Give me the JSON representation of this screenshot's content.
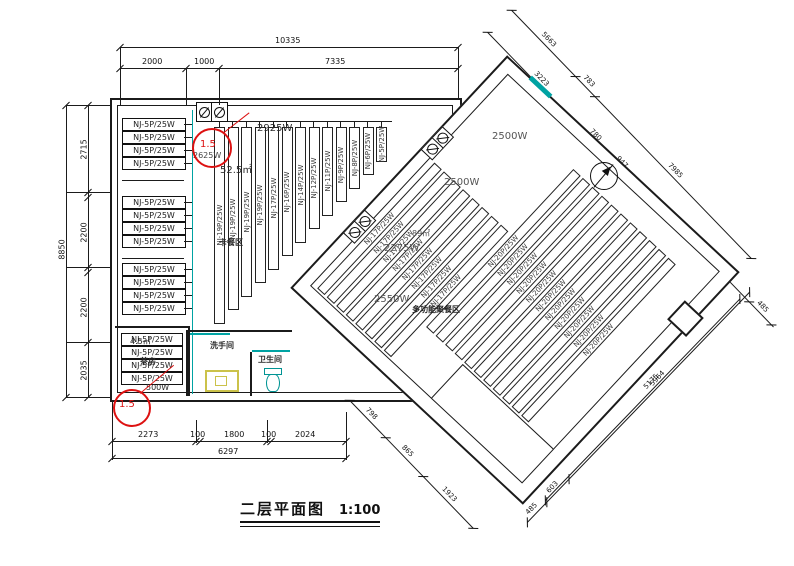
{
  "title": {
    "text": "二层平面图",
    "scale": "1:100"
  },
  "colors": {
    "line": "#1b1b1b",
    "teal": "#00a3a3",
    "red": "#dd1111",
    "yellow": "#cbc24a"
  },
  "left_room": {
    "panel_label": "NJ-5P/25W",
    "panel_groups": [
      4,
      4,
      4
    ],
    "strips": [
      {
        "label": "NJ-19P/25W"
      },
      {
        "label": "NJ-19P/25W"
      },
      {
        "label": "NJ-19P/25W"
      },
      {
        "label": "NJ-19P/25W"
      },
      {
        "label": "NJ-17P/25W"
      },
      {
        "label": "NJ-16P/25W"
      },
      {
        "label": "NJ-14P/25W"
      },
      {
        "label": "NJ-12P/25W"
      },
      {
        "label": "NJ-11P/25W"
      },
      {
        "label": "NJ-9P/25W"
      },
      {
        "label": "NJ-8P/25W"
      },
      {
        "label": "NJ-6P/25W"
      },
      {
        "label": "NJ-5P/25W"
      }
    ],
    "texts": {
      "power_a": "2625W",
      "power_b": "2925W",
      "area": "52.5㎡",
      "zone": "卡餐区"
    },
    "tea_room": {
      "name": "茶房",
      "area": "4.5㎡",
      "power": "500W",
      "panel_label": "NJ-5P/25W",
      "panel_count": 4
    },
    "washroom_label": "洗手间",
    "toilet_label": "卫生间",
    "markup_top": "1.5",
    "markup_bottom": "1.5"
  },
  "rotated_room": {
    "strips_left": {
      "label": "NJ-17P/25W",
      "count": 8
    },
    "strips_right": {
      "label": "NJ-20P/25W",
      "count": 11
    },
    "texts": {
      "power_top": "2500W",
      "power_mid": "2500W",
      "power_low": "2275W",
      "power_bottom": "2550W",
      "area": "89㎡",
      "zone": "多功能聚餐区"
    }
  },
  "dimensions": {
    "top": {
      "overall": "10335",
      "segments": [
        "2000",
        "1000",
        "7335"
      ]
    },
    "left": {
      "overall": "8850",
      "segments": [
        "2715",
        "2200",
        "2200",
        "2035"
      ]
    },
    "bottom": {
      "overall": "6297",
      "segments": [
        "2273",
        "100",
        "1800",
        "100",
        "2024"
      ]
    },
    "rot_outer_top": [
      "5663",
      "783",
      "7985"
    ],
    "rot_inner_top": [
      "3223",
      "780",
      "947"
    ],
    "rot_right": [
      "1785",
      "485"
    ],
    "rot_bottom_right": {
      "inner": "5175",
      "outer": "5964",
      "corner": [
        "485",
        "603"
      ]
    },
    "rot_bottom_left": [
      "798",
      "865",
      "1923"
    ]
  }
}
